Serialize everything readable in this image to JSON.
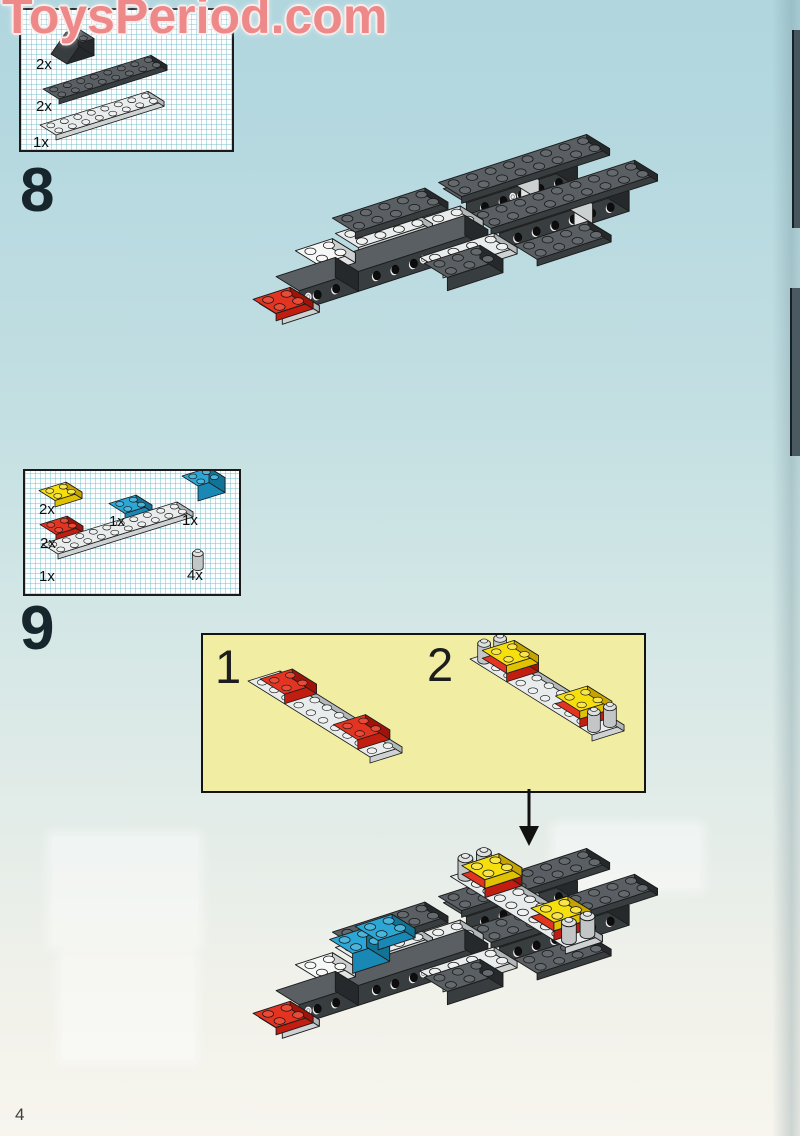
{
  "watermark": {
    "text": "ToysPeriod.com"
  },
  "page": {
    "number": "4"
  },
  "steps": {
    "step8": {
      "number": "8",
      "parts": [
        {
          "label": "2x",
          "part": "dark-gray-slope-brick-2x2"
        },
        {
          "label": "2x",
          "part": "dark-gray-plate-2x8"
        },
        {
          "label": "1x",
          "part": "light-gray-plate-2x8"
        }
      ]
    },
    "step9": {
      "number": "9",
      "parts": [
        {
          "label": "2x",
          "part": "yellow-plate-2x2"
        },
        {
          "label": "1x",
          "part": "blue-plate-2x2"
        },
        {
          "label": "1x",
          "part": "blue-brick-2x2"
        },
        {
          "label": "2x",
          "part": "red-plate-2x2"
        },
        {
          "label": "1x",
          "part": "light-gray-plate-2x10"
        },
        {
          "label": "4x",
          "part": "light-gray-round-brick-1x1"
        }
      ],
      "substeps": [
        {
          "label": "1"
        },
        {
          "label": "2"
        }
      ]
    }
  },
  "palette": {
    "dk": {
      "top": "#595f63",
      "front": "#383d40",
      "side": "#26292c",
      "stud": "#63696d"
    },
    "lt": {
      "top": "#e9ecec",
      "front": "#ced2d3",
      "side": "#b2b7b9",
      "stud": "#eff1f1"
    },
    "wht": {
      "top": "#f6f7f7",
      "front": "#e2e4e4",
      "side": "#cdd0d0",
      "stud": "#f8f8f8"
    },
    "red": {
      "top": "#e23420",
      "front": "#c11d10",
      "side": "#9e140a",
      "stud": "#e84b38"
    },
    "yel": {
      "top": "#f6df0e",
      "front": "#e0c103",
      "side": "#c5a400",
      "stud": "#f8e54a"
    },
    "blu": {
      "top": "#2ba6d5",
      "front": "#1988b5",
      "side": "#117395",
      "stud": "#4cb5dc"
    },
    "gry": {
      "top": "#dfe1e1",
      "front": "#c3c6c7",
      "side": "#aaadae",
      "stud": "#e8eaea"
    }
  },
  "illustrations": {
    "box8parts": {
      "U": [
        13.5,
        -4.2
      ],
      "V": [
        8,
        5
      ],
      "W": 5,
      "o": [
        0,
        0
      ],
      "pieces": [
        {
          "o": [
            30,
            44
          ],
          "t": "wedge",
          "x": 0,
          "y": 0,
          "z": 0,
          "w": 2,
          "d": 2,
          "h": 3.4,
          "c": "dk",
          "studs": true
        },
        {
          "o": [
            22,
            84
          ],
          "t": "box",
          "x": 0,
          "y": 0,
          "z": 0,
          "w": 8,
          "d": 2,
          "h": 1,
          "c": "dk",
          "studs": true
        },
        {
          "o": [
            19,
            120
          ],
          "t": "box",
          "x": 0,
          "y": 0,
          "z": 0,
          "w": 8,
          "d": 2,
          "h": 1,
          "c": "lt",
          "studs": true
        }
      ]
    },
    "box9parts": {
      "U": [
        13.5,
        -4.2
      ],
      "V": [
        8,
        5
      ],
      "W": 5,
      "o": [
        0,
        0
      ],
      "pieces": [
        {
          "o": [
            14,
            26
          ],
          "t": "box",
          "x": 0,
          "y": 0,
          "z": 0,
          "w": 2,
          "d": 2,
          "h": 1.3,
          "c": "yel",
          "studs": true
        },
        {
          "o": [
            84,
            39
          ],
          "t": "box",
          "x": 0,
          "y": 0,
          "z": 0,
          "w": 2,
          "d": 2,
          "h": 1.3,
          "c": "blu",
          "studs": true
        },
        {
          "o": [
            157,
            20
          ],
          "t": "box",
          "x": 0,
          "y": 0,
          "z": 0,
          "w": 2,
          "d": 2,
          "h": 3,
          "c": "blu",
          "studs": true
        },
        {
          "o": [
            15,
            60
          ],
          "t": "box",
          "x": 0,
          "y": 0,
          "z": 0,
          "w": 2,
          "d": 2,
          "h": 1.3,
          "c": "red",
          "studs": true
        },
        {
          "o": [
            17,
            78
          ],
          "t": "box",
          "x": 0,
          "y": 0,
          "z": 0,
          "w": 10,
          "d": 2,
          "h": 1,
          "c": "lt",
          "studs": true
        },
        {
          "o": [
            162,
            96
          ],
          "t": "cyl",
          "x": 0,
          "y": 0,
          "z": 0,
          "h": 2.8,
          "c": "gry"
        }
      ]
    },
    "substeps": {
      "U": [
        16,
        -5
      ],
      "V": [
        12.2,
        7.6
      ],
      "W": 6,
      "o": [
        45,
        52
      ],
      "pieces": [
        {
          "t": "box",
          "x": 0,
          "y": 0,
          "z": 0,
          "w": 2,
          "d": 10,
          "h": 1,
          "c": "lt",
          "studs": true
        },
        {
          "t": "box",
          "x": 0,
          "y": 1,
          "z": 1,
          "w": 2,
          "d": 2,
          "h": 1.6,
          "c": "red",
          "studs": true
        },
        {
          "t": "box",
          "x": 0,
          "y": 7,
          "z": 1,
          "w": 2,
          "d": 2,
          "h": 1.6,
          "c": "red",
          "studs": true
        },
        {
          "o": [
            267,
            30
          ],
          "t": "box",
          "x": 0,
          "y": 0,
          "z": 0,
          "w": 2,
          "d": 10,
          "h": 1,
          "c": "lt",
          "studs": true
        },
        {
          "o": [
            267,
            30
          ],
          "t": "cyl",
          "x": 0,
          "y": 0,
          "z": 1,
          "h": 2.8,
          "c": "gry"
        },
        {
          "o": [
            267,
            30
          ],
          "t": "cyl",
          "x": 1,
          "y": 0,
          "z": 1,
          "h": 2.8,
          "c": "gry"
        },
        {
          "o": [
            267,
            30
          ],
          "t": "box",
          "x": 0,
          "y": 1,
          "z": 1,
          "w": 2,
          "d": 2,
          "h": 1.4,
          "c": "red"
        },
        {
          "o": [
            267,
            30
          ],
          "t": "box",
          "x": 0,
          "y": 1,
          "z": 2.4,
          "w": 2,
          "d": 2,
          "h": 1.3,
          "c": "yel",
          "studs": true
        },
        {
          "o": [
            267,
            30
          ],
          "t": "box",
          "x": 0,
          "y": 7,
          "z": 1,
          "w": 2,
          "d": 2,
          "h": 1.4,
          "c": "red"
        },
        {
          "o": [
            267,
            30
          ],
          "t": "box",
          "x": 0,
          "y": 7,
          "z": 2.4,
          "w": 2,
          "d": 2,
          "h": 1.3,
          "c": "yel",
          "studs": true
        },
        {
          "o": [
            267,
            30
          ],
          "t": "cyl",
          "x": 0,
          "y": 9,
          "z": 1,
          "h": 2.8,
          "c": "gry"
        },
        {
          "o": [
            267,
            30
          ],
          "t": "cyl",
          "x": 1,
          "y": 9,
          "z": 1,
          "h": 2.8,
          "c": "gry"
        }
      ]
    },
    "step8": {
      "U": [
        18.5,
        -6
      ],
      "V": [
        11.5,
        7.1
      ],
      "W": 6.6,
      "o": [
        74,
        156
      ],
      "pieces": [
        {
          "t": "box",
          "x": 9.2,
          "y": -2.5,
          "z": 1,
          "w": 6,
          "d": 2,
          "h": 3,
          "c": "dk",
          "holes": 5,
          "logo": 2
        },
        {
          "t": "box",
          "x": 12.1,
          "y": -2.45,
          "z": 1,
          "w": 1,
          "d": 2,
          "h": 3,
          "c": "wht"
        },
        {
          "t": "box",
          "x": 9,
          "y": -2.6,
          "z": 4,
          "w": 8,
          "d": 2,
          "h": 1,
          "c": "dk",
          "studs": true
        },
        {
          "t": "box",
          "x": 9,
          "y": 0.7,
          "z": 0,
          "w": 7,
          "d": 2,
          "h": 3,
          "c": "dk",
          "holes": 6
        },
        {
          "t": "box",
          "x": 13,
          "y": 0.75,
          "z": 0,
          "w": 1,
          "d": 2,
          "h": 3,
          "c": "wht"
        },
        {
          "t": "box",
          "x": 8.6,
          "y": 0.6,
          "z": 3,
          "w": 9,
          "d": 2,
          "h": 1,
          "c": "dk",
          "studs": true
        },
        {
          "t": "box",
          "x": 9.6,
          "y": 3,
          "z": 0,
          "w": 4,
          "d": 2,
          "h": 1,
          "c": "dk",
          "studs": true
        },
        {
          "t": "box",
          "x": 4.8,
          "y": -0.4,
          "z": 3,
          "w": 4,
          "d": 2,
          "h": 1,
          "c": "lt",
          "studs": true
        },
        {
          "t": "box",
          "x": 2.8,
          "y": -1.6,
          "z": 3,
          "w": 4,
          "d": 2,
          "h": 1,
          "c": "lt",
          "studs": true
        },
        {
          "t": "box",
          "x": 3.2,
          "y": -2.5,
          "z": 4,
          "w": 5,
          "d": 2,
          "h": 1,
          "c": "dk",
          "studs": true
        },
        {
          "t": "box",
          "x": 1.8,
          "y": 0,
          "z": 0,
          "w": 7,
          "d": 2,
          "h": 3,
          "c": "dk",
          "holes": 6,
          "logo": 3
        },
        {
          "t": "box",
          "x": 5.2,
          "y": 1.9,
          "z": 1,
          "w": 4,
          "d": 2,
          "h": 1,
          "c": "lt",
          "studs": true
        },
        {
          "t": "box",
          "x": 5,
          "y": 2.6,
          "z": 0,
          "w": 3,
          "d": 2,
          "h": 2,
          "c": "dk",
          "studs": true
        },
        {
          "t": "box",
          "x": 0.2,
          "y": -0.9,
          "z": 3,
          "w": 2,
          "d": 2,
          "h": 1.5,
          "c": "wht",
          "studs": true
        },
        {
          "t": "box",
          "x": -1.4,
          "y": 0,
          "z": 0,
          "w": 3.2,
          "d": 2,
          "h": 3,
          "c": "dk",
          "holes": 2,
          "logo": 0
        },
        {
          "t": "box",
          "x": -2.4,
          "y": 0.15,
          "z": -1,
          "w": 2,
          "d": 2,
          "h": 1,
          "c": "lt"
        },
        {
          "t": "box",
          "x": -2.8,
          "y": 0.25,
          "z": 0,
          "w": 2,
          "d": 2,
          "h": 1.1,
          "c": "red",
          "studs": true
        }
      ]
    },
    "step9": {
      "extends": "step8",
      "U": [
        18.5,
        -6
      ],
      "V": [
        11.5,
        7.1
      ],
      "W": 6.6,
      "o": [
        74,
        186
      ],
      "pieces": [
        {
          "t": "box",
          "x": 10.2,
          "y": -3.5,
          "z": 5,
          "w": 2,
          "d": 10,
          "h": 1,
          "c": "lt",
          "studs": true
        },
        {
          "t": "cyl",
          "x": 10.2,
          "y": -3.5,
          "z": 6,
          "h": 2.8,
          "c": "gry"
        },
        {
          "t": "cyl",
          "x": 11.2,
          "y": -3.5,
          "z": 6,
          "h": 2.8,
          "c": "gry"
        },
        {
          "t": "box",
          "x": 10.2,
          "y": -2.5,
          "z": 6,
          "w": 2,
          "d": 2,
          "h": 1.4,
          "c": "red"
        },
        {
          "t": "box",
          "x": 10.2,
          "y": -2.5,
          "z": 7.4,
          "w": 2,
          "d": 2,
          "h": 1.3,
          "c": "yel",
          "studs": true
        },
        {
          "t": "box",
          "x": 10.2,
          "y": 3.5,
          "z": 6,
          "w": 2,
          "d": 2,
          "h": 1.4,
          "c": "red"
        },
        {
          "t": "box",
          "x": 10.2,
          "y": 3.5,
          "z": 7.4,
          "w": 2,
          "d": 2,
          "h": 1.3,
          "c": "yel",
          "studs": true
        },
        {
          "t": "cyl",
          "x": 10.2,
          "y": 5.5,
          "z": 6,
          "h": 2.8,
          "c": "gry"
        },
        {
          "t": "cyl",
          "x": 11.2,
          "y": 5.5,
          "z": 6,
          "h": 2.8,
          "c": "gry"
        },
        {
          "t": "box",
          "x": 2.3,
          "y": -1.3,
          "z": 3,
          "w": 2,
          "d": 2,
          "h": 3,
          "c": "blu",
          "studs": true
        },
        {
          "t": "box",
          "x": 3.8,
          "y": -1.5,
          "z": 5,
          "w": 2,
          "d": 2,
          "h": 1.4,
          "c": "blu",
          "studs": true
        }
      ]
    }
  }
}
